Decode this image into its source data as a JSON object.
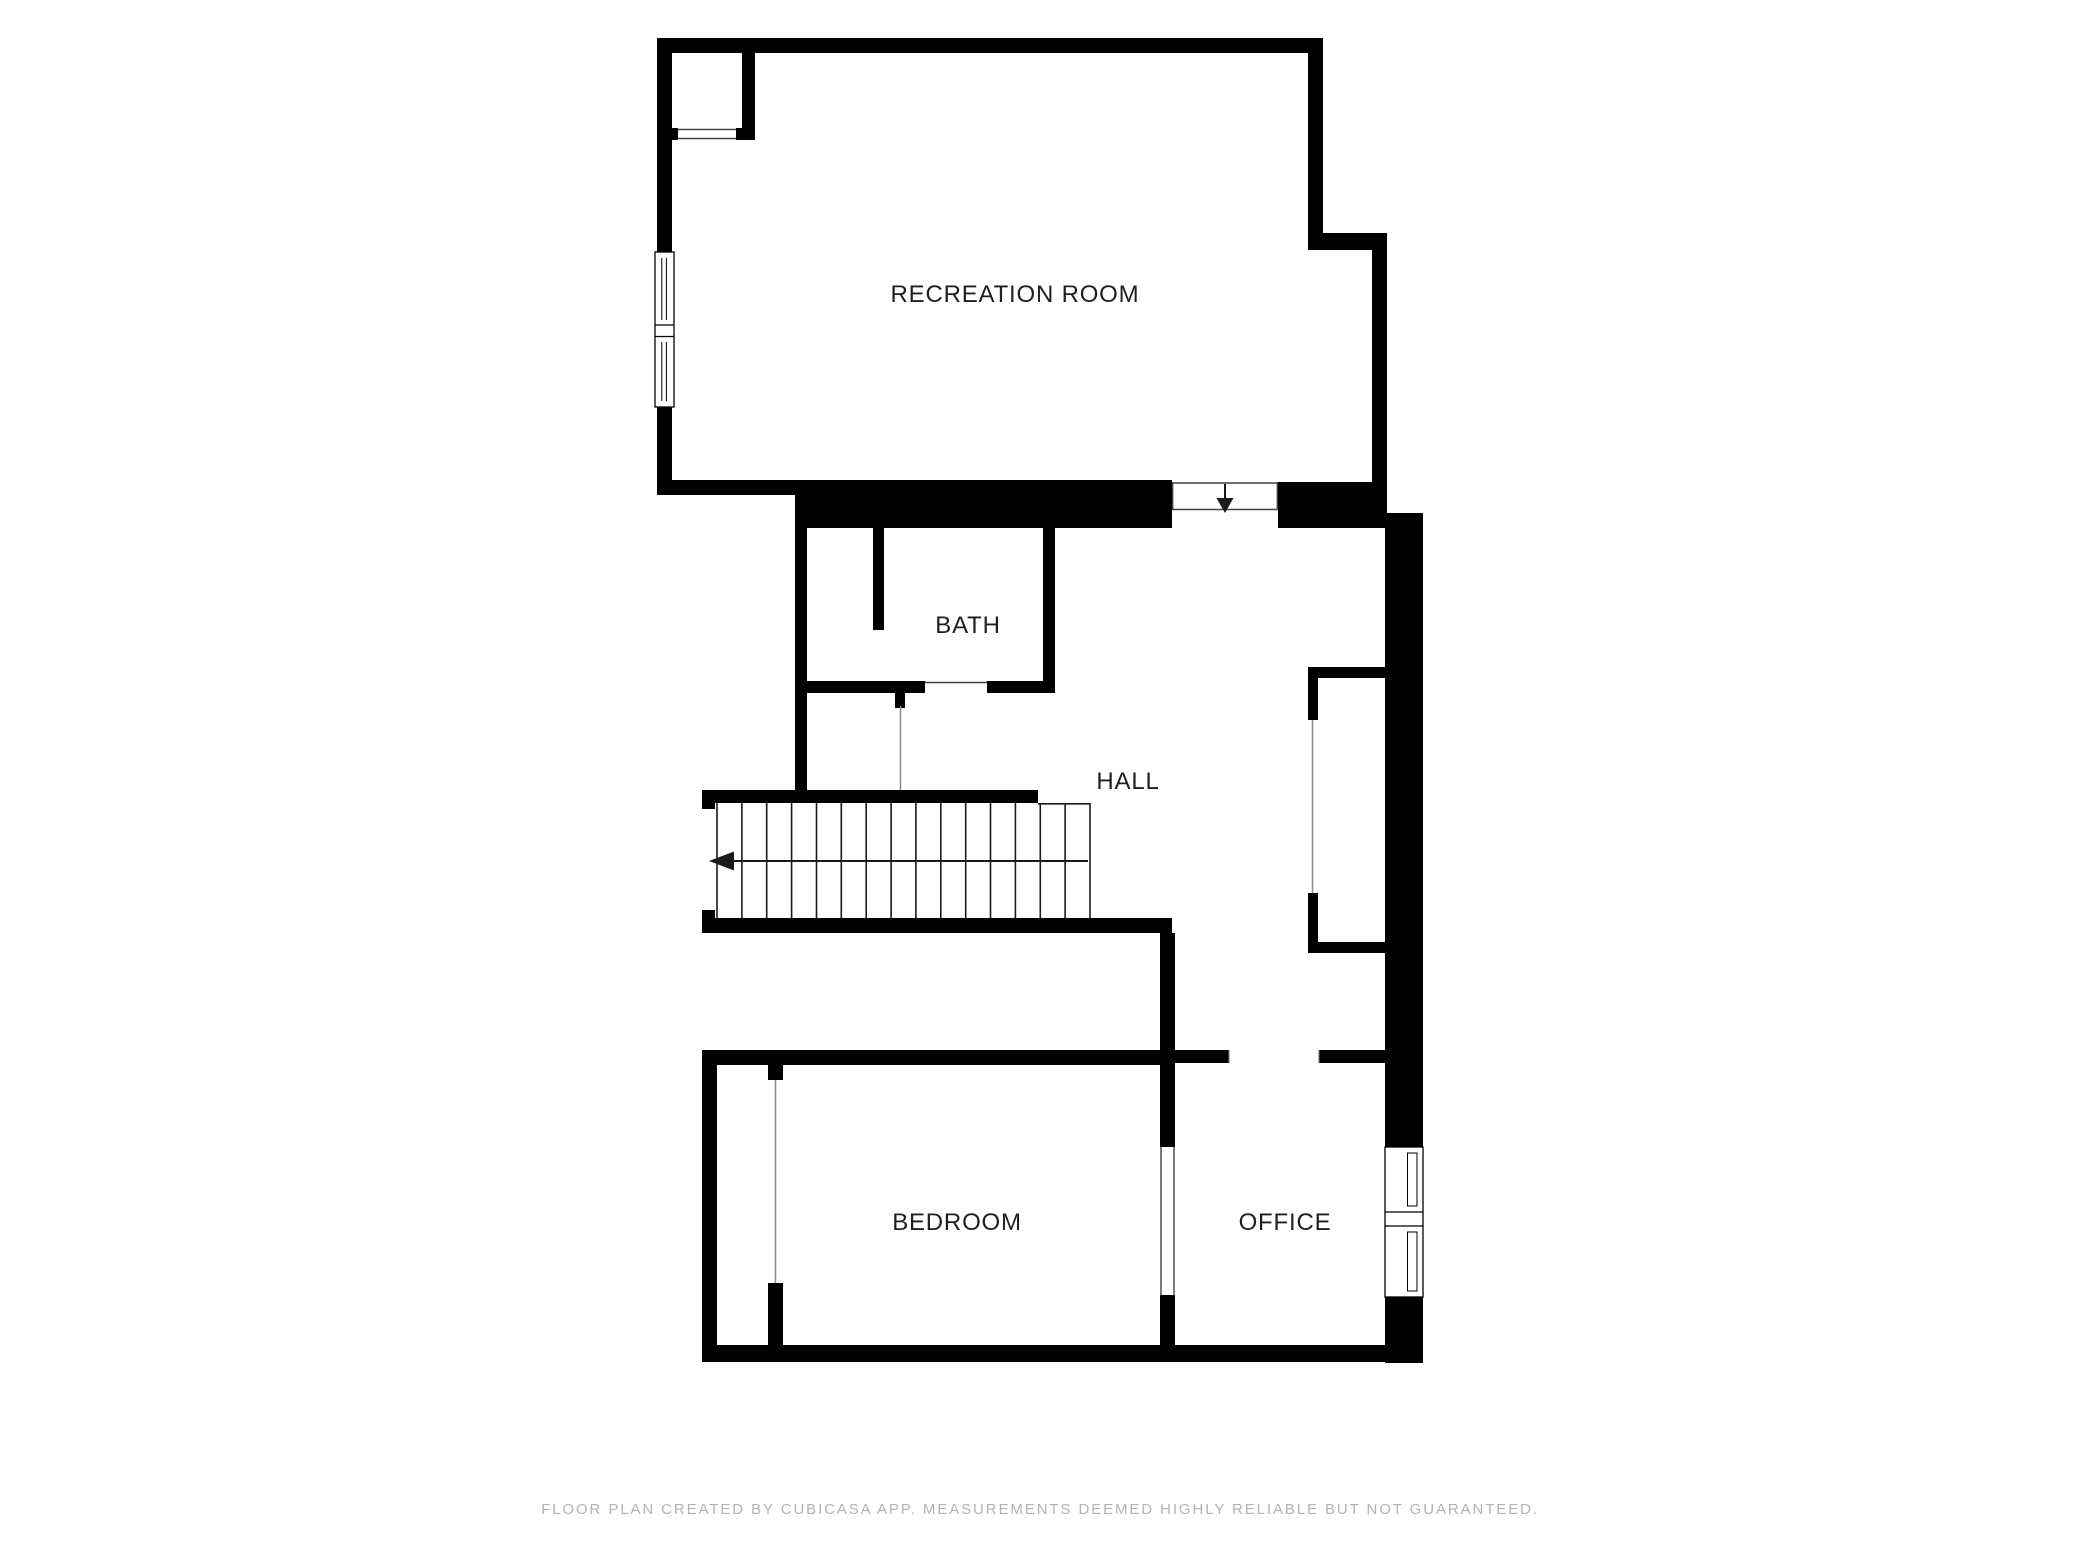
{
  "page": {
    "background_color": "#ffffff",
    "wall_color": "#000000",
    "label_color": "#1f1f1f",
    "thin_line_color": "#444444",
    "door_line_color": "#8a8a8a"
  },
  "floor_plan": {
    "rooms": [
      {
        "name": "RECREATION ROOM",
        "label_x": 1015,
        "label_y": 302
      },
      {
        "name": "BATH",
        "label_x": 968,
        "label_y": 633
      },
      {
        "name": "HALL",
        "label_x": 1128,
        "label_y": 789
      },
      {
        "name": "BEDROOM",
        "label_x": 957,
        "label_y": 1230
      },
      {
        "name": "OFFICE",
        "label_x": 1285,
        "label_y": 1230
      }
    ],
    "symbols": [
      {
        "name": "entry-arrow-down",
        "meaning": "opening from recreation room down into hall"
      },
      {
        "name": "stairs-arrow-left",
        "meaning": "stair run direction, 15 treads"
      }
    ],
    "windows": [
      {
        "name": "recreation-room-west-window"
      },
      {
        "name": "office-east-window"
      }
    ]
  },
  "footer": {
    "text": "FLOOR PLAN CREATED BY CUBICASA APP. MEASUREMENTS DEEMED HIGHLY RELIABLE BUT NOT GUARANTEED."
  }
}
